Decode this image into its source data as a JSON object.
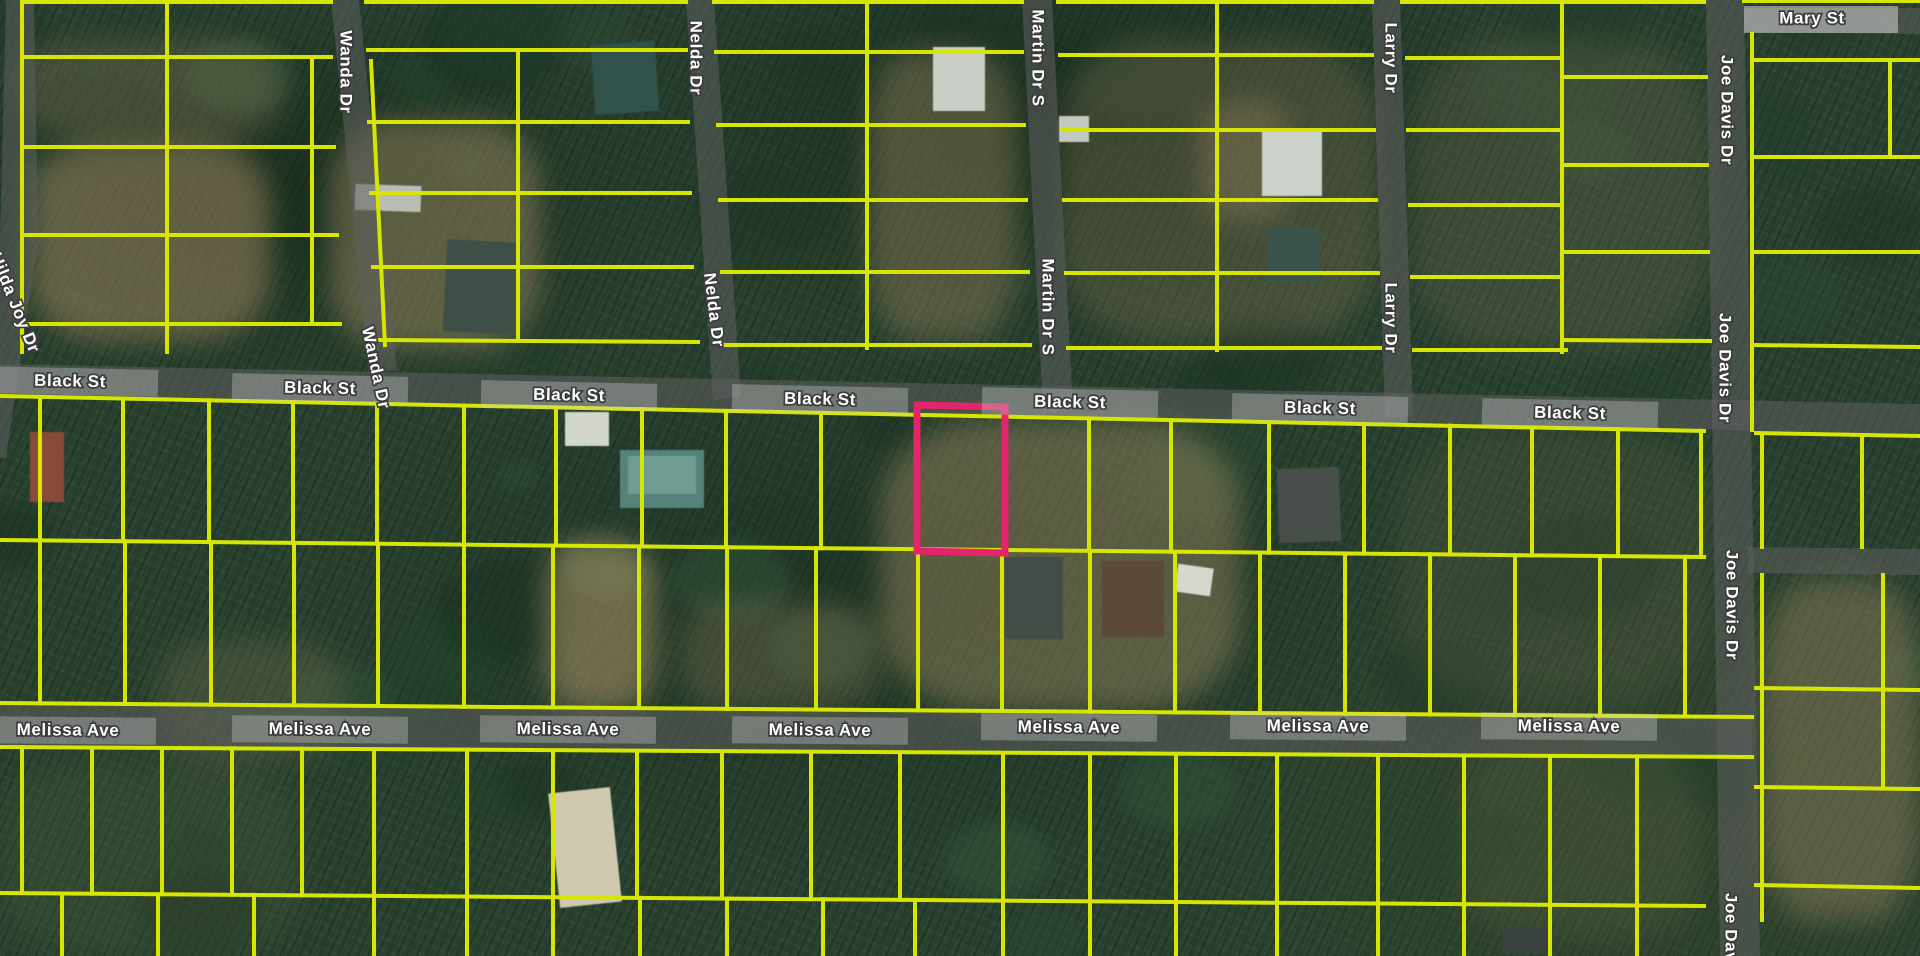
{
  "map": {
    "view_type": "satellite-parcel-map",
    "canvas": {
      "width": 1920,
      "height": 956
    },
    "colors": {
      "parcel_line": "#d6e600",
      "highlight_line": "#e4256b",
      "road_overlay": "rgba(95,95,95,0.55)",
      "road_label_backing": "rgba(205,205,205,0.35)",
      "mary_st_backing": "rgba(210,210,210,0.55)",
      "label_text": "#ffffff",
      "label_halo": "#3c3c3c"
    },
    "highlighted_parcel": {
      "points": [
        [
          917,
          405
        ],
        [
          1005,
          407
        ],
        [
          1005,
          553
        ],
        [
          917,
          551
        ]
      ],
      "stroke_width": 7
    },
    "street_labels": [
      {
        "name": "Black St",
        "instances": [
          [
            70,
            382,
            1.2
          ],
          [
            320,
            389,
            1.2
          ],
          [
            569,
            396,
            1.2
          ],
          [
            820,
            400,
            1.2
          ],
          [
            1070,
            403,
            1.2
          ],
          [
            1320,
            409,
            1.2
          ],
          [
            1570,
            414,
            1.2
          ]
        ],
        "backing": true
      },
      {
        "name": "Melissa Ave",
        "instances": [
          [
            68,
            731,
            0.5
          ],
          [
            320,
            730,
            0.5
          ],
          [
            568,
            730,
            0.5
          ],
          [
            820,
            731,
            0.5
          ],
          [
            1069,
            728,
            0.5
          ],
          [
            1318,
            727,
            0.5
          ],
          [
            1569,
            727,
            0.5
          ]
        ],
        "backing": true
      },
      {
        "name": "Mary St",
        "instances": [
          [
            1812,
            19,
            0
          ]
        ],
        "backing": false
      },
      {
        "name": "Wanda Dr",
        "instances": [
          [
            345,
            72,
            90
          ],
          [
            375,
            368,
            78
          ]
        ],
        "backing": false
      },
      {
        "name": "Nelda Dr",
        "instances": [
          [
            695,
            58,
            90
          ],
          [
            713,
            310,
            83
          ]
        ],
        "backing": false
      },
      {
        "name": "Martin Dr S",
        "instances": [
          [
            1037,
            58,
            90
          ],
          [
            1047,
            307,
            90
          ]
        ],
        "backing": false
      },
      {
        "name": "Larry Dr",
        "instances": [
          [
            1390,
            58,
            90
          ],
          [
            1390,
            318,
            90
          ]
        ],
        "backing": false
      },
      {
        "name": "Joe Davis Dr",
        "instances": [
          [
            1726,
            110,
            90
          ],
          [
            1724,
            368,
            90
          ],
          [
            1731,
            605,
            90
          ],
          [
            1730,
            948,
            90
          ]
        ],
        "backing": false
      },
      {
        "name": "Hilda Joy Dr",
        "instances": [
          [
            14,
            303,
            68
          ]
        ],
        "backing": false
      }
    ],
    "roads": [
      {
        "id": "hilda-joy-dr",
        "points": [
          [
            6,
            0
          ],
          [
            34,
            0
          ],
          [
            38,
            240
          ],
          [
            6,
            458
          ],
          [
            0,
            458
          ],
          [
            0,
            240
          ]
        ]
      },
      {
        "id": "wanda-dr",
        "points": [
          [
            331,
            0
          ],
          [
            359,
            0
          ],
          [
            397,
            370
          ],
          [
            369,
            374
          ]
        ]
      },
      {
        "id": "nelda-dr",
        "points": [
          [
            686,
            0
          ],
          [
            714,
            0
          ],
          [
            741,
            397
          ],
          [
            713,
            400
          ]
        ]
      },
      {
        "id": "martin-dr-s",
        "points": [
          [
            1022,
            0
          ],
          [
            1052,
            0
          ],
          [
            1073,
            409
          ],
          [
            1043,
            412
          ]
        ]
      },
      {
        "id": "larry-dr",
        "points": [
          [
            1372,
            0
          ],
          [
            1400,
            0
          ],
          [
            1413,
            416
          ],
          [
            1385,
            418
          ]
        ]
      },
      {
        "id": "joe-davis-dr",
        "points": [
          [
            1706,
            0
          ],
          [
            1744,
            0
          ],
          [
            1760,
            956
          ],
          [
            1720,
            956
          ]
        ]
      },
      {
        "id": "black-st",
        "points": [
          [
            0,
            364
          ],
          [
            1920,
            404
          ],
          [
            1920,
            434
          ],
          [
            0,
            394
          ]
        ]
      },
      {
        "id": "melissa-ave",
        "points": [
          [
            0,
            704
          ],
          [
            1752,
            717
          ],
          [
            1752,
            755
          ],
          [
            0,
            748
          ]
        ]
      },
      {
        "id": "mary-st",
        "points": [
          [
            1744,
            8
          ],
          [
            1920,
            8
          ],
          [
            1920,
            34
          ],
          [
            1744,
            32
          ]
        ]
      },
      {
        "id": "east-spur",
        "points": [
          [
            1748,
            547
          ],
          [
            1920,
            549
          ],
          [
            1920,
            575
          ],
          [
            1748,
            573
          ]
        ]
      }
    ],
    "mary_st_backing_rect": [
      1744,
      6,
      154,
      27
    ],
    "parcel_lines": {
      "segments": [
        [
          22,
          2,
          331,
          2
        ],
        [
          366,
          2,
          686,
          2
        ],
        [
          714,
          2,
          1022,
          2
        ],
        [
          1058,
          2,
          1372,
          2
        ],
        [
          1402,
          2,
          1704,
          2
        ],
        [
          1744,
          1,
          1920,
          1
        ],
        [
          22,
          2,
          22,
          352
        ],
        [
          167,
          2,
          167,
          352
        ],
        [
          312,
          57,
          312,
          324
        ],
        [
          22,
          57,
          331,
          57
        ],
        [
          22,
          147,
          334,
          147
        ],
        [
          22,
          235,
          337,
          235
        ],
        [
          22,
          324,
          340,
          324
        ],
        [
          371,
          61,
          385,
          345
        ],
        [
          518,
          50,
          518,
          340
        ],
        [
          368,
          50,
          686,
          50
        ],
        [
          369,
          122,
          688,
          122
        ],
        [
          371,
          193,
          690,
          193
        ],
        [
          373,
          267,
          692,
          267
        ],
        [
          375,
          340,
          698,
          342
        ],
        [
          867,
          2,
          867,
          348
        ],
        [
          716,
          52,
          1022,
          52
        ],
        [
          718,
          125,
          1024,
          125
        ],
        [
          720,
          200,
          1026,
          200
        ],
        [
          722,
          272,
          1028,
          272
        ],
        [
          724,
          345,
          1030,
          345
        ],
        [
          1217,
          2,
          1217,
          350
        ],
        [
          1060,
          55,
          1372,
          55
        ],
        [
          1062,
          130,
          1374,
          130
        ],
        [
          1064,
          200,
          1376,
          200
        ],
        [
          1066,
          273,
          1378,
          273
        ],
        [
          1068,
          348,
          1380,
          348
        ],
        [
          1562,
          2,
          1562,
          352
        ],
        [
          1407,
          58,
          1562,
          58
        ],
        [
          1408,
          130,
          1562,
          130
        ],
        [
          1410,
          205,
          1562,
          205
        ],
        [
          1412,
          277,
          1562,
          277
        ],
        [
          1414,
          350,
          1566,
          350
        ],
        [
          1562,
          77,
          1706,
          77
        ],
        [
          1562,
          165,
          1707,
          165
        ],
        [
          1562,
          252,
          1708,
          252
        ],
        [
          1562,
          340,
          1710,
          341
        ],
        [
          1752,
          34,
          1752,
          430
        ],
        [
          1890,
          60,
          1890,
          157
        ],
        [
          1752,
          60,
          1920,
          60
        ],
        [
          1752,
          157,
          1920,
          157
        ],
        [
          1752,
          252,
          1920,
          252
        ],
        [
          1752,
          345,
          1920,
          347
        ],
        [
          1756,
          433,
          1920,
          436
        ],
        [
          0,
          396,
          1704,
          431
        ],
        [
          0,
          540,
          1704,
          557
        ],
        [
          0,
          703,
          1752,
          717
        ],
        [
          0,
          747,
          1752,
          757
        ],
        [
          0,
          893,
          1704,
          906
        ],
        [
          1762,
          437,
          1762,
          547
        ],
        [
          1862,
          437,
          1862,
          547
        ],
        [
          1756,
          688,
          1920,
          690
        ],
        [
          1756,
          787,
          1920,
          789
        ],
        [
          1756,
          885,
          1920,
          888
        ],
        [
          1762,
          575,
          1762,
          920
        ],
        [
          1883,
          575,
          1883,
          787
        ]
      ],
      "mid_upper_xs": [
        40,
        123,
        209,
        293,
        377,
        464,
        556,
        642,
        726,
        821,
        917,
        1005,
        1089,
        1171,
        1269,
        1364,
        1450,
        1532,
        1618,
        1701
      ],
      "mid_lower_xs": [
        40,
        125,
        211,
        294,
        378,
        464,
        553,
        639,
        727,
        816,
        918,
        1002,
        1090,
        1175,
        1260,
        1345,
        1430,
        1515,
        1600,
        1685
      ],
      "bottom_upper_xs": [
        22,
        92,
        162,
        232,
        302,
        374,
        467,
        553,
        637,
        722,
        811,
        900,
        1003,
        1090,
        1176,
        1277,
        1378,
        1464,
        1550,
        1637
      ],
      "bottom_lower_xs": [
        62,
        158,
        254,
        374,
        467,
        553,
        640,
        727,
        823,
        915,
        1003,
        1090,
        1176,
        1277,
        1378,
        1464,
        1550,
        1637
      ],
      "edges": {
        "black_bottom": [
          396,
          0.0205
        ],
        "mid": [
          540,
          0.01
        ],
        "melissa_top": [
          703,
          0.008
        ],
        "melissa_bottom": [
          747,
          0.006
        ],
        "bottom_mid": [
          893,
          0.0076
        ],
        "canvas_bottom": [
          956,
          0
        ]
      }
    },
    "features": [
      {
        "id": "house-dark-teal-top",
        "rect": [
          593,
          43,
          64,
          70
        ],
        "fill": "#31524a",
        "rot": -4
      },
      {
        "id": "house-gray-wanda",
        "rect": [
          445,
          241,
          74,
          92
        ],
        "fill": "#3e4f47",
        "rot": 3
      },
      {
        "id": "trailer-light",
        "rect": [
          355,
          185,
          66,
          26
        ],
        "fill": "#b9bdb3",
        "rot": 2
      },
      {
        "id": "barn-white-roof",
        "rect": [
          933,
          47,
          52,
          64
        ],
        "fill": "#c9cfc7",
        "rot": 0
      },
      {
        "id": "house-white-martin",
        "rect": [
          1262,
          130,
          60,
          66
        ],
        "fill": "#ccd1c9",
        "rot": 0
      },
      {
        "id": "house-dark-martin",
        "rect": [
          1267,
          228,
          52,
          54
        ],
        "fill": "#3a544b",
        "rot": 0
      },
      {
        "id": "shed-small-white",
        "rect": [
          1059,
          116,
          30,
          26
        ],
        "fill": "#c4c9bf",
        "rot": 0
      },
      {
        "id": "building-teal-roof",
        "rect": [
          620,
          450,
          84,
          58
        ],
        "fill": "#55837a",
        "rot": 0
      },
      {
        "id": "building-teal-roof-top",
        "rect": [
          628,
          456,
          68,
          38
        ],
        "fill": "#6f9d92",
        "rot": 0
      },
      {
        "id": "house-dark-larry",
        "rect": [
          1278,
          468,
          62,
          74
        ],
        "fill": "#484f4a",
        "rot": -2
      },
      {
        "id": "house-brown",
        "rect": [
          1102,
          561,
          62,
          76
        ],
        "fill": "#5c4a39",
        "rot": 0
      },
      {
        "id": "trailer-white",
        "rect": [
          1176,
          566,
          36,
          28
        ],
        "fill": "#d6d8d0",
        "rot": 8
      },
      {
        "id": "house-dark-mid",
        "rect": [
          1005,
          557,
          58,
          82
        ],
        "fill": "#444c47",
        "rot": 0
      },
      {
        "id": "patch-red-roof",
        "rect": [
          30,
          432,
          34,
          70
        ],
        "fill": "#8a4a3a",
        "rot": 0
      },
      {
        "id": "patch-white-sand",
        "rect": [
          554,
          790,
          62,
          115
        ],
        "fill": "#cfc9b0",
        "rot": -6
      },
      {
        "id": "trailer-dark-bottom",
        "rect": [
          1502,
          928,
          52,
          26
        ],
        "fill": "#39423d",
        "rot": 0
      },
      {
        "id": "cars-white",
        "rect": [
          565,
          412,
          44,
          34
        ],
        "fill": "#d3d6cd",
        "rot": 0
      }
    ],
    "ground_patches": [
      [
        30,
        140,
        240,
        200,
        "#a58a62",
        0.5
      ],
      [
        330,
        120,
        210,
        230,
        "#a89066",
        0.45
      ],
      [
        20,
        40,
        260,
        100,
        "#97825d",
        0.3
      ],
      [
        868,
        50,
        150,
        290,
        "#9c855e",
        0.4
      ],
      [
        1060,
        40,
        320,
        300,
        "#8f7a58",
        0.3
      ],
      [
        1200,
        100,
        90,
        120,
        "#a08a62",
        0.35
      ],
      [
        1410,
        40,
        300,
        310,
        "#7d6f52",
        0.25
      ],
      [
        880,
        420,
        360,
        290,
        "#a08a62",
        0.45
      ],
      [
        545,
        540,
        110,
        170,
        "#ad9468",
        0.55
      ],
      [
        1400,
        430,
        310,
        270,
        "#6f6a4e",
        0.2
      ],
      [
        1762,
        580,
        158,
        340,
        "#94825f",
        0.45
      ],
      [
        0,
        760,
        300,
        196,
        "#55603f",
        0.25
      ],
      [
        680,
        600,
        200,
        110,
        "#8f7a58",
        0.3
      ],
      [
        1460,
        740,
        240,
        200,
        "#5f6844",
        0.25
      ],
      [
        160,
        640,
        180,
        120,
        "#7c7350",
        0.3
      ]
    ]
  }
}
